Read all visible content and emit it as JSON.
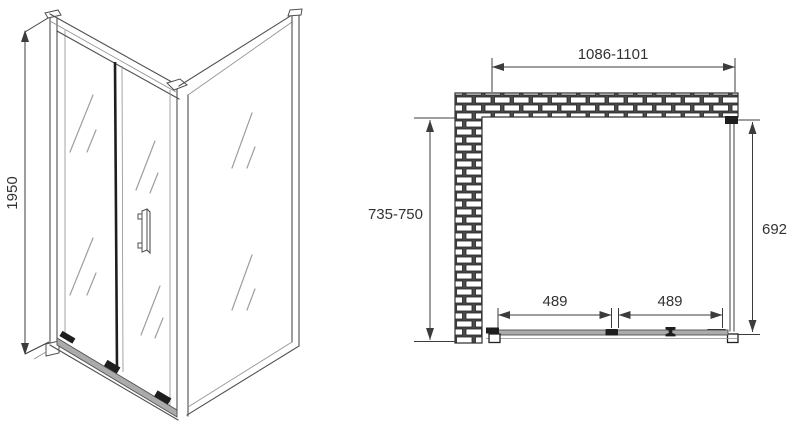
{
  "front_view": {
    "height_mm": "1950"
  },
  "plan_view": {
    "width_top": "1086-1101",
    "depth_left": "735-750",
    "side_right": "692",
    "door_left": "489",
    "door_right": "489"
  },
  "colors": {
    "line": "#4f4f4f",
    "line_light": "#8f8f8f",
    "dim": "#3c3c3c",
    "text": "#333333",
    "hardware": "#1e1e1e",
    "track_fill": "#ababab",
    "mortar": "#4a4a4a",
    "brick": "#ffffff",
    "glass_shine": "#9e9e9e",
    "background": "#ffffff"
  }
}
